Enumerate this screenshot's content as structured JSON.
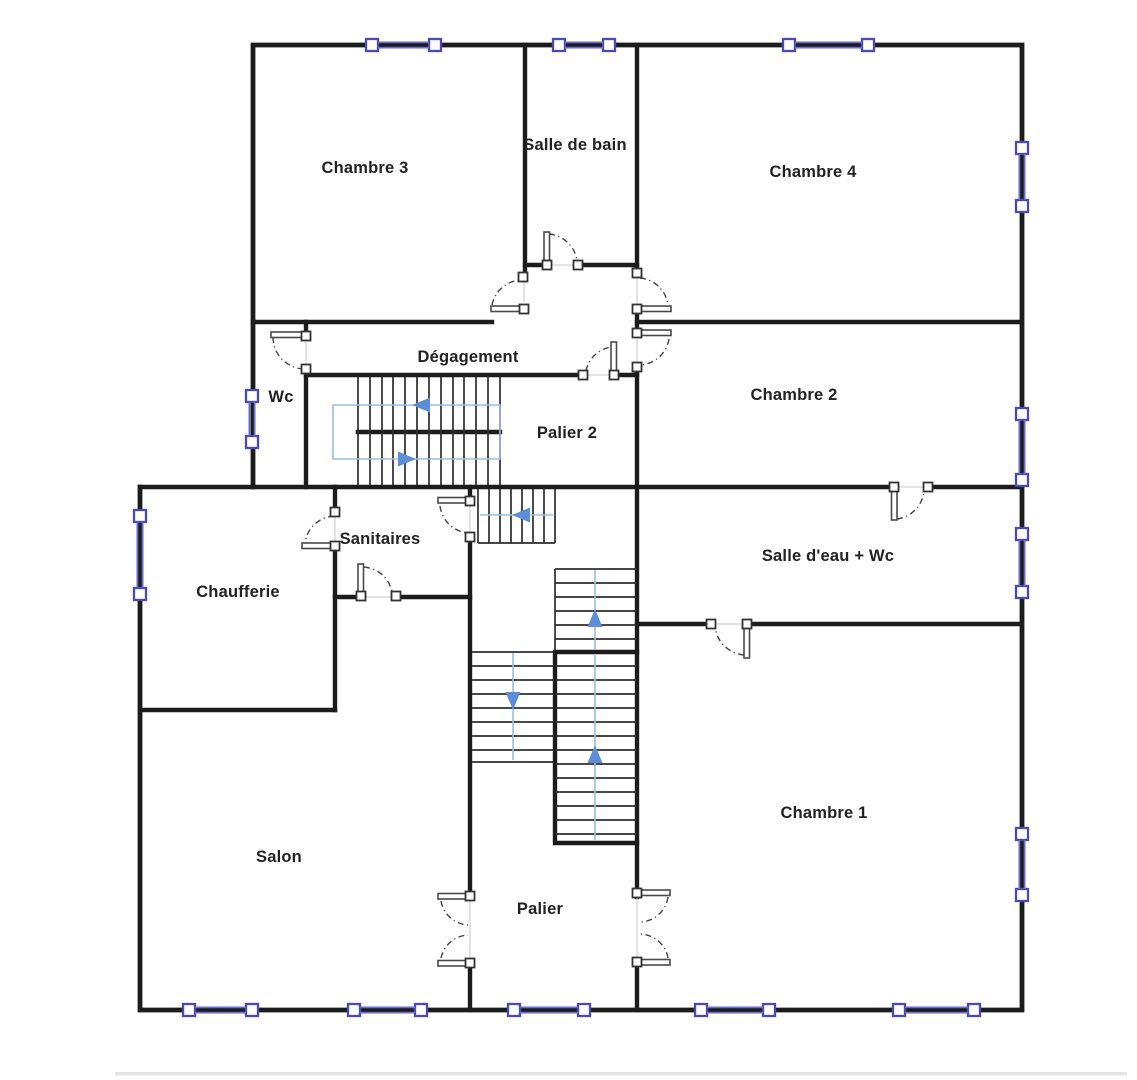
{
  "document": {
    "type": "floor-plan",
    "language": "fr",
    "background": "#ffffff"
  },
  "rooms": [
    {
      "id": "chambre-3",
      "label": "Chambre 3"
    },
    {
      "id": "salle-de-bain",
      "label": "Salle de bain"
    },
    {
      "id": "chambre-4",
      "label": "Chambre 4"
    },
    {
      "id": "degagement",
      "label": "Dégagement"
    },
    {
      "id": "wc",
      "label": "Wc"
    },
    {
      "id": "palier-2",
      "label": "Palier 2"
    },
    {
      "id": "chambre-2",
      "label": "Chambre 2"
    },
    {
      "id": "sanitaires",
      "label": "Sanitaires"
    },
    {
      "id": "chaufferie",
      "label": "Chaufferie"
    },
    {
      "id": "salle-d-eau-wc",
      "label": "Salle d'eau + Wc"
    },
    {
      "id": "salon",
      "label": "Salon"
    },
    {
      "id": "palier",
      "label": "Palier"
    },
    {
      "id": "chambre-1",
      "label": "Chambre 1"
    }
  ],
  "symbols": {
    "window_count": 14,
    "door_count": 11,
    "double_door_count": 2,
    "stair_flight_count": 5
  },
  "colors": {
    "wall": "#1c1c1c",
    "tread": "#2e2e2e",
    "window_frame": "#4a49b8",
    "window_rail": "#6a6ad0",
    "door": "#4a4a4a",
    "door_gap": "#d8d8d8",
    "stair_path": "#9dbde8",
    "stair_arrow": "#5b8dd9",
    "label": "#222222",
    "background": "#ffffff"
  }
}
